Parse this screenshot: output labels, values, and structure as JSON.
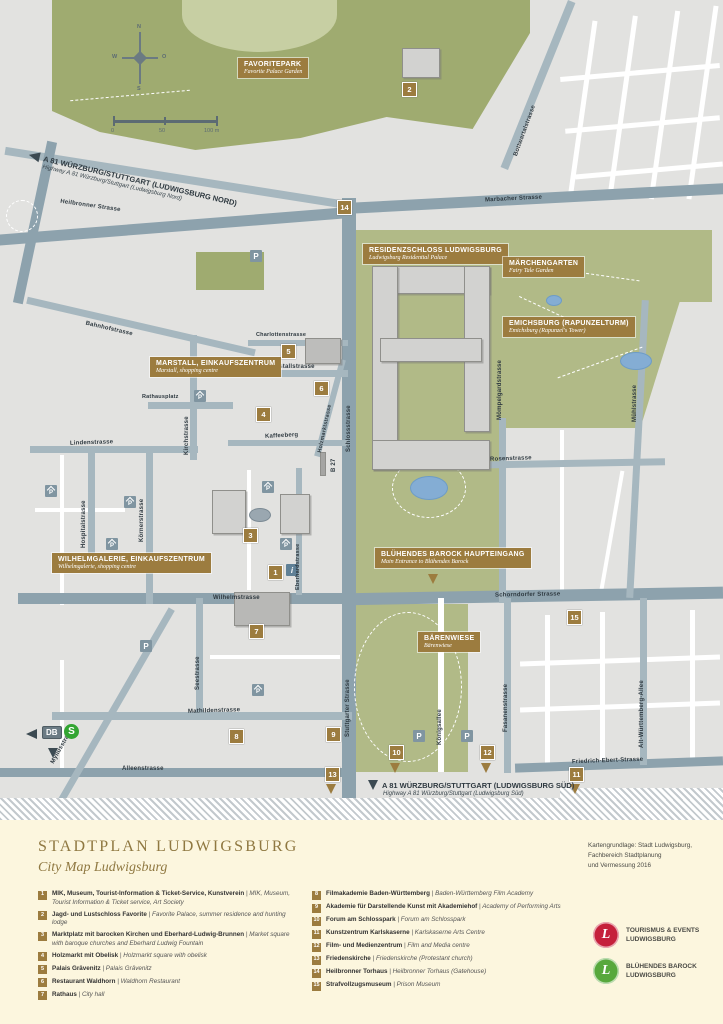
{
  "map": {
    "compass": {
      "n": "N",
      "e": "O",
      "s": "S",
      "w": "W"
    },
    "scale": {
      "start": "0",
      "mid": "50",
      "end": "100 m"
    },
    "parking_label": "P",
    "info_label": "i",
    "transit": {
      "db": "DB",
      "s": "S"
    },
    "highway_north": {
      "title": "A 81 WÜRZBURG/STUTTGART (LUDWIGSBURG NORD)",
      "sub": "Highway A 81 Würzburg/Stuttgart (Ludwigsburg Nord)"
    },
    "highway_south": {
      "title": "A 81 WÜRZBURG/STUTTGART (LUDWIGSBURG SÜD)",
      "sub": "Highway A 81 Würzburg/Stuttgart (Ludwigsburg Süd)"
    },
    "poi": [
      {
        "title": "FAVORITEPARK",
        "sub": "Favorite Palace Garden"
      },
      {
        "title": "RESIDENZSCHLOSS LUDWIGSBURG",
        "sub": "Ludwigsburg Residential Palace"
      },
      {
        "title": "MÄRCHENGARTEN",
        "sub": "Fairy Tale Garden"
      },
      {
        "title": "EMICHSBURG (RAPUNZELTURM)",
        "sub": "Emichsburg (Rapunzel's Tower)"
      },
      {
        "title": "MARSTALL, EINKAUFSZENTRUM",
        "sub": "Marstall, shopping centre"
      },
      {
        "title": "WILHELMGALERIE, EINKAUFSZENTRUM",
        "sub": "Wilhelmgalerie, shopping centre"
      },
      {
        "title": "BLÜHENDES BAROCK HAUPTEINGANG",
        "sub": "Main Entrance to Blühendes Barock"
      },
      {
        "title": "BÄRENWIESE",
        "sub": "Bärenwiese"
      }
    ],
    "streets": [
      {
        "name": "Heilbronner Strasse"
      },
      {
        "name": "Marbacher Strasse"
      },
      {
        "name": "Bottwartalstrasse"
      },
      {
        "name": "Bahnhofstrasse"
      },
      {
        "name": "Rathausplatz"
      },
      {
        "name": "Charlottenstrasse"
      },
      {
        "name": "Marstallstrasse"
      },
      {
        "name": "Kirchstrasse"
      },
      {
        "name": "Kaffeeberg"
      },
      {
        "name": "Holzmarktstrasse"
      },
      {
        "name": "Schlossstrasse"
      },
      {
        "name": "B 27"
      },
      {
        "name": "Lindenstrasse"
      },
      {
        "name": "Hospitalstrasse"
      },
      {
        "name": "Körnerstrasse"
      },
      {
        "name": "Wilhelmstrasse"
      },
      {
        "name": "Eberhardstrasse"
      },
      {
        "name": "Seestrasse"
      },
      {
        "name": "Mathildenstrasse"
      },
      {
        "name": "Myliusstrasse"
      },
      {
        "name": "Alleenstrasse"
      },
      {
        "name": "Stuttgarter Strasse"
      },
      {
        "name": "Königsallee"
      },
      {
        "name": "Fasanenstrasse"
      },
      {
        "name": "Mömpelgardstrasse"
      },
      {
        "name": "Rosenstrasse"
      },
      {
        "name": "Mühlstrasse"
      },
      {
        "name": "Schorndorfer Strasse"
      },
      {
        "name": "Alt-Württemberg-Allee"
      },
      {
        "name": "Friedrich-Ebert-Strasse"
      }
    ],
    "markers": [
      "1",
      "2",
      "3",
      "4",
      "5",
      "6",
      "7",
      "8",
      "9",
      "10",
      "11",
      "12",
      "13",
      "14",
      "15"
    ]
  },
  "footer": {
    "title": "STADTPLAN LUDWIGSBURG",
    "subtitle": "City Map Ludwigsburg",
    "credit": [
      "Kartengrundlage: Stadt Ludwigsburg,",
      "Fachbereich Stadtplanung",
      "und Vermessung 2016"
    ],
    "legend_left": [
      {
        "num": "1",
        "de": "MIK, Museum, Tourist-Information & Ticket-Service, Kunstverein",
        "en": "MIK, Museum, Tourist Information & Ticket service, Art Society"
      },
      {
        "num": "2",
        "de": "Jagd- und Lustschloss Favorite",
        "en": "Favorite Palace, summer residence and hunting lodge"
      },
      {
        "num": "3",
        "de": "Marktplatz mit barocken Kirchen und Eberhard-Ludwig-Brunnen",
        "en": "Market square with baroque churches and Eberhard Ludwig Fountain"
      },
      {
        "num": "4",
        "de": "Holzmarkt mit Obelisk",
        "en": "Holzmarkt square with obelisk"
      },
      {
        "num": "5",
        "de": "Palais Grävenitz",
        "en": "Palais Grävenitz"
      },
      {
        "num": "6",
        "de": "Restaurant Waldhorn",
        "en": "Waldhorn Restaurant"
      },
      {
        "num": "7",
        "de": "Rathaus",
        "en": "City hall"
      }
    ],
    "legend_right": [
      {
        "num": "8",
        "de": "Filmakademie Baden-Württemberg",
        "en": "Baden-Württemberg Film Academy"
      },
      {
        "num": "9",
        "de": "Akademie für Darstellende Kunst mit Akademiehof",
        "en": "Academy of Performing Arts"
      },
      {
        "num": "10",
        "de": "Forum am Schlosspark",
        "en": "Forum am Schlosspark"
      },
      {
        "num": "11",
        "de": "Kunstzentrum Karlskaserne",
        "en": "Karlskaserne Arts Centre"
      },
      {
        "num": "12",
        "de": "Film- und Medienzentrum",
        "en": "Film and Media centre"
      },
      {
        "num": "13",
        "de": "Friedenskirche",
        "en": "Friedenskirche (Protestant church)"
      },
      {
        "num": "14",
        "de": "Heilbronner Torhaus",
        "en": "Heilbronner Torhaus (Gatehouse)"
      },
      {
        "num": "15",
        "de": "Strafvollzugsmuseum",
        "en": "Prison Museum"
      }
    ],
    "logos": [
      {
        "letter": "L",
        "line1": "TOURISMUS & EVENTS",
        "line2": "LUDWIGSBURG",
        "color": "#c5203b"
      },
      {
        "letter": "L",
        "line1": "BLÜHENDES BAROCK",
        "line2": "LUDWIGSBURG",
        "color": "#57a83c"
      }
    ]
  }
}
